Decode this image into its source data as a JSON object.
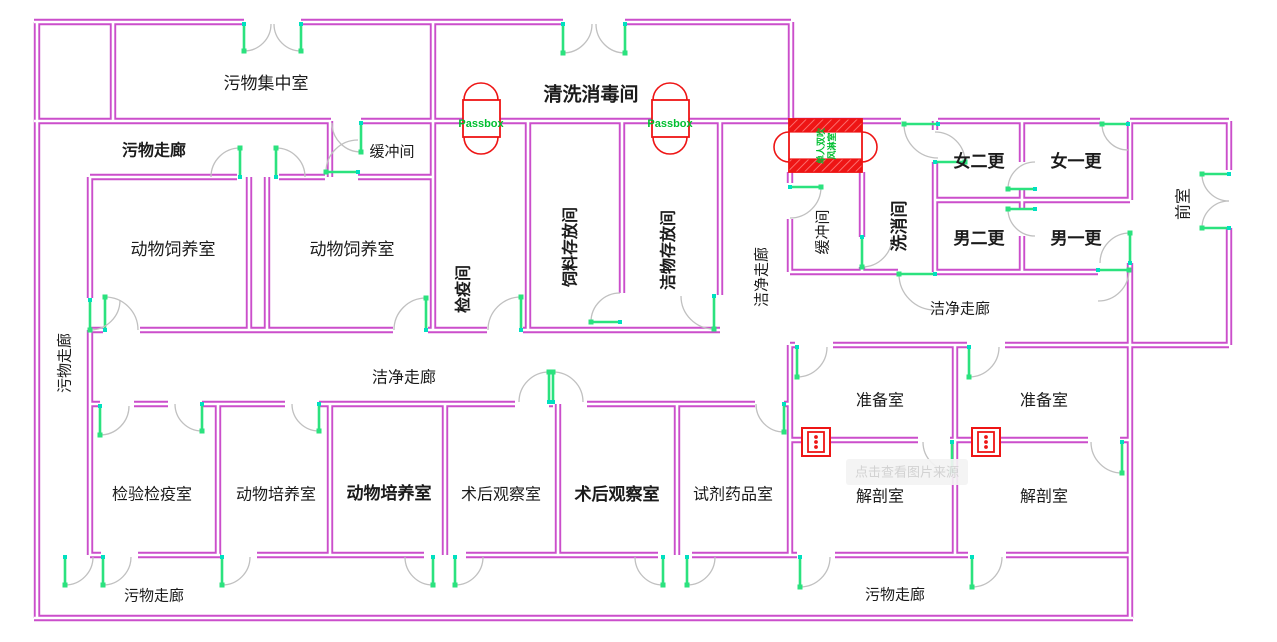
{
  "plan": {
    "rooms": {
      "waste_collection": "污物集中室",
      "washing_disinfection": "清洗消毒间",
      "quarantine": "检疫间",
      "feed_storage": "饲料存放间",
      "clean_storage": "洁物存放间",
      "animal_breeding_1": "动物饲养室",
      "animal_breeding_2": "动物饲养室",
      "buffer_top": "缓冲间",
      "buffer_right": "缓冲间",
      "wash_room": "洗消间",
      "female_second_change": "女二更",
      "female_first_change": "女一更",
      "male_second_change": "男二更",
      "male_first_change": "男一更",
      "anteroom": "前室",
      "prep_room_1": "准备室",
      "prep_room_2": "准备室",
      "dissection_1": "解剖室",
      "dissection_2": "解剖室",
      "inspection_quarantine": "检验检疫室",
      "animal_culture_1": "动物培养室",
      "animal_culture_2": "动物培养室",
      "postop_observation_1": "术后观察室",
      "postop_observation_2": "术后观察室",
      "reagent_drug": "试剂药品室"
    },
    "corridors": {
      "dirty_top": "污物走廊",
      "dirty_left": "污物走廊",
      "dirty_bottom_left": "污物走廊",
      "dirty_bottom_right": "污物走廊",
      "clean_center": "洁净走廊",
      "clean_mid_vertical": "洁净走廊",
      "clean_right": "洁净走廊"
    },
    "equipment": {
      "passbox_1": "Passbox",
      "passbox_2": "Passbox",
      "air_shower_line_1": "单人双吹",
      "air_shower_line_2": "风淋室"
    },
    "watermark": "点击查看图片来源",
    "colors": {
      "wall": "#cb4ecb",
      "door": "#2be27e",
      "door_hinge": "#00e0c0",
      "swing_arc": "#c0c0c0",
      "red": "#ee1515",
      "hatch_line": "#ff8585",
      "cyan": "#19dede",
      "passbox_text": "#00bf30",
      "label": "#1b1b1b",
      "watermark_bg": "#f3f3f3",
      "watermark_text": "#d2d2d2"
    }
  }
}
